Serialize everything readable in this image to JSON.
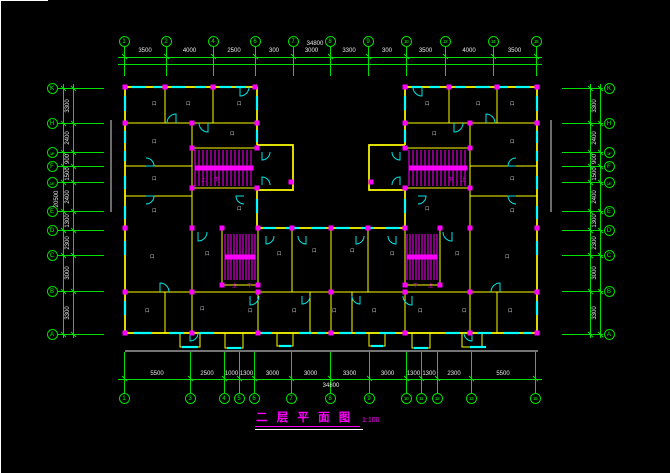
{
  "window": {
    "width": 670,
    "height": 473,
    "background": "#000000"
  },
  "colors": {
    "grid": "#00e000",
    "walls": "#ffff00",
    "windows": "#00ffff",
    "columns_stairs": "#ff00ff",
    "dim_text": "#e8e8e8",
    "section_line": "#a8a8a8"
  },
  "title_block": {
    "title": "二 层 平 面 图",
    "scale": "1:100"
  },
  "grid": {
    "top_axes": [
      {
        "label": "1",
        "x": 124
      },
      {
        "label": "2",
        "x": 166
      },
      {
        "label": "4",
        "x": 213
      },
      {
        "label": "6",
        "x": 255
      },
      {
        "label": "7",
        "x": 293
      },
      {
        "label": "8",
        "x": 330
      },
      {
        "label": "9",
        "x": 368
      },
      {
        "label": "10",
        "x": 406
      },
      {
        "label": "12",
        "x": 445
      },
      {
        "label": "14",
        "x": 493
      },
      {
        "label": "15",
        "x": 536
      }
    ],
    "top_dims": [
      "3500",
      "4000",
      "2500",
      "300",
      "3000",
      "3300",
      "300",
      "3500",
      "4000",
      "3500"
    ],
    "top_overall": "34800",
    "bottom_axes": [
      {
        "label": "1",
        "x": 124
      },
      {
        "label": "3",
        "x": 190
      },
      {
        "label": "4",
        "x": 224
      },
      {
        "label": "5",
        "x": 239
      },
      {
        "label": "6",
        "x": 254
      },
      {
        "label": "7",
        "x": 291
      },
      {
        "label": "8",
        "x": 330
      },
      {
        "label": "9",
        "x": 369
      },
      {
        "label": "10",
        "x": 406
      },
      {
        "label": "11",
        "x": 421
      },
      {
        "label": "12",
        "x": 437
      },
      {
        "label": "13",
        "x": 471
      },
      {
        "label": "15",
        "x": 535
      }
    ],
    "bottom_dims": [
      "5500",
      "2500",
      "1000",
      "1300",
      "3000",
      "3000",
      "3300",
      "3000",
      "1300",
      "1300",
      "2300",
      "5500"
    ],
    "bottom_overall": "34800",
    "side_axes": [
      {
        "label": "K",
        "y": 88
      },
      {
        "label": "H",
        "y": 123
      },
      {
        "label": "1/F",
        "y": 152
      },
      {
        "label": "F",
        "y": 166
      },
      {
        "label": "1/E",
        "y": 182
      },
      {
        "label": "E",
        "y": 211
      },
      {
        "label": "D",
        "y": 230
      },
      {
        "label": "C",
        "y": 255
      },
      {
        "label": "B",
        "y": 291
      },
      {
        "label": "A",
        "y": 334
      }
    ],
    "side_dims": [
      "3300",
      "2400",
      "900",
      "1500",
      "2400",
      "1300",
      "2300",
      "3000",
      "3300"
    ],
    "left_overall": "20500"
  },
  "drawing": {
    "columns": [
      [
        125,
        87
      ],
      [
        165,
        87
      ],
      [
        213,
        87
      ],
      [
        255,
        87
      ],
      [
        405,
        87
      ],
      [
        449,
        87
      ],
      [
        497,
        87
      ],
      [
        537,
        87
      ],
      [
        125,
        123
      ],
      [
        192,
        123
      ],
      [
        257,
        123
      ],
      [
        405,
        123
      ],
      [
        470,
        123
      ],
      [
        537,
        123
      ],
      [
        192,
        148
      ],
      [
        257,
        148
      ],
      [
        192,
        188
      ],
      [
        257,
        188
      ],
      [
        291,
        182
      ],
      [
        405,
        148
      ],
      [
        470,
        148
      ],
      [
        405,
        188
      ],
      [
        470,
        188
      ],
      [
        371,
        182
      ],
      [
        125,
        228
      ],
      [
        192,
        228
      ],
      [
        222,
        228
      ],
      [
        258,
        228
      ],
      [
        292,
        228
      ],
      [
        331,
        228
      ],
      [
        368,
        228
      ],
      [
        405,
        228
      ],
      [
        440,
        228
      ],
      [
        470,
        228
      ],
      [
        537,
        228
      ],
      [
        222,
        285
      ],
      [
        258,
        285
      ],
      [
        405,
        285
      ],
      [
        440,
        285
      ],
      [
        125,
        292
      ],
      [
        192,
        292
      ],
      [
        258,
        292
      ],
      [
        331,
        292
      ],
      [
        405,
        292
      ],
      [
        470,
        292
      ],
      [
        537,
        292
      ],
      [
        125,
        333
      ],
      [
        192,
        333
      ],
      [
        258,
        333
      ],
      [
        331,
        333
      ],
      [
        405,
        333
      ],
      [
        470,
        333
      ],
      [
        537,
        333
      ]
    ],
    "windows_h": [
      [
        131,
        87,
        15
      ],
      [
        153,
        87,
        9
      ],
      [
        171,
        87,
        14
      ],
      [
        195,
        87,
        11
      ],
      [
        220,
        87,
        11
      ],
      [
        236,
        87,
        10
      ],
      [
        411,
        87,
        10
      ],
      [
        430,
        87,
        10
      ],
      [
        455,
        87,
        11
      ],
      [
        476,
        87,
        14
      ],
      [
        500,
        87,
        8
      ],
      [
        516,
        87,
        14
      ],
      [
        263,
        228,
        13
      ],
      [
        286,
        228,
        13
      ],
      [
        311,
        228,
        14
      ],
      [
        336,
        228,
        14
      ],
      [
        361,
        228,
        13
      ],
      [
        386,
        228,
        13
      ],
      [
        134,
        333,
        18
      ],
      [
        169,
        333,
        15
      ],
      [
        199,
        333,
        15
      ],
      [
        261,
        333,
        11
      ],
      [
        299,
        333,
        13
      ],
      [
        317,
        333,
        9
      ],
      [
        339,
        333,
        12
      ],
      [
        355,
        333,
        11
      ],
      [
        380,
        333,
        15
      ],
      [
        445,
        333,
        15
      ],
      [
        477,
        333,
        14
      ],
      [
        504,
        333,
        15
      ],
      [
        523,
        333,
        9
      ],
      [
        182,
        347,
        16
      ],
      [
        227,
        348,
        14
      ],
      [
        279,
        346,
        12
      ],
      [
        371,
        346,
        12
      ],
      [
        414,
        348,
        14
      ],
      [
        470,
        347,
        16
      ]
    ],
    "windows_v": [
      [
        125,
        96,
        15
      ],
      [
        125,
        131,
        12
      ],
      [
        125,
        151,
        10
      ],
      [
        125,
        176,
        13
      ],
      [
        125,
        206,
        13
      ],
      [
        125,
        241,
        14
      ],
      [
        125,
        301,
        14
      ],
      [
        537,
        96,
        15
      ],
      [
        537,
        131,
        12
      ],
      [
        537,
        151,
        10
      ],
      [
        537,
        176,
        13
      ],
      [
        537,
        206,
        13
      ],
      [
        537,
        241,
        14
      ],
      [
        537,
        301,
        14
      ],
      [
        257,
        96,
        14
      ],
      [
        257,
        130,
        12
      ],
      [
        257,
        199,
        14
      ],
      [
        405,
        96,
        14
      ],
      [
        405,
        130,
        12
      ],
      [
        405,
        199,
        14
      ]
    ],
    "doors": [
      [
        176,
        123,
        9,
        270,
        180
      ],
      [
        240,
        87,
        9,
        90,
        0
      ],
      [
        146,
        166,
        8,
        0,
        270
      ],
      [
        208,
        123,
        9,
        90,
        180
      ],
      [
        146,
        196,
        8,
        0,
        90
      ],
      [
        244,
        196,
        8,
        180,
        90
      ],
      [
        262,
        152,
        8,
        90,
        0
      ],
      [
        262,
        185,
        8,
        270,
        0
      ],
      [
        486,
        123,
        9,
        270,
        0
      ],
      [
        422,
        87,
        9,
        90,
        180
      ],
      [
        516,
        166,
        8,
        180,
        270
      ],
      [
        454,
        123,
        9,
        90,
        0
      ],
      [
        516,
        196,
        8,
        180,
        90
      ],
      [
        418,
        196,
        8,
        0,
        90
      ],
      [
        400,
        152,
        8,
        90,
        180
      ],
      [
        400,
        185,
        8,
        270,
        180
      ],
      [
        198,
        232,
        9,
        90,
        0
      ],
      [
        266,
        236,
        8,
        90,
        0
      ],
      [
        306,
        236,
        8,
        90,
        180
      ],
      [
        356,
        236,
        8,
        90,
        0
      ],
      [
        396,
        236,
        8,
        90,
        180
      ],
      [
        452,
        232,
        9,
        90,
        180
      ],
      [
        160,
        292,
        9,
        270,
        0
      ],
      [
        250,
        296,
        9,
        90,
        0
      ],
      [
        302,
        296,
        8,
        90,
        0
      ],
      [
        360,
        296,
        8,
        90,
        180
      ],
      [
        412,
        296,
        9,
        90,
        180
      ],
      [
        500,
        292,
        9,
        270,
        180
      ],
      [
        190,
        333,
        8,
        90,
        0
      ],
      [
        472,
        333,
        8,
        90,
        180
      ]
    ],
    "stairs": [
      {
        "x": 195,
        "y": 150,
        "w": 58,
        "h": 36,
        "step": 4
      },
      {
        "x": 409,
        "y": 150,
        "w": 58,
        "h": 36,
        "step": 4
      },
      {
        "x": 225,
        "y": 234,
        "w": 30,
        "h": 46,
        "step": 3
      },
      {
        "x": 407,
        "y": 234,
        "w": 30,
        "h": 46,
        "step": 3
      }
    ],
    "stair_marks": [
      {
        "x": 201,
        "y": 181,
        "t": "上"
      },
      {
        "x": 214,
        "y": 181,
        "t": "下"
      },
      {
        "x": 448,
        "y": 181,
        "t": "下"
      },
      {
        "x": 461,
        "y": 181,
        "t": "上"
      },
      {
        "x": 232,
        "y": 287,
        "t": "上"
      },
      {
        "x": 247,
        "y": 287,
        "t": "下"
      },
      {
        "x": 413,
        "y": 287,
        "t": "下"
      },
      {
        "x": 428,
        "y": 287,
        "t": "上"
      }
    ],
    "room_marker_char": "口",
    "room_markers": [
      [
        152,
        105
      ],
      [
        186,
        105
      ],
      [
        237,
        105
      ],
      [
        152,
        143
      ],
      [
        230,
        135
      ],
      [
        152,
        180
      ],
      [
        152,
        212
      ],
      [
        237,
        210
      ],
      [
        510,
        105
      ],
      [
        476,
        105
      ],
      [
        425,
        105
      ],
      [
        510,
        143
      ],
      [
        432,
        135
      ],
      [
        510,
        180
      ],
      [
        510,
        212
      ],
      [
        425,
        210
      ],
      [
        150,
        258
      ],
      [
        205,
        255
      ],
      [
        277,
        255
      ],
      [
        312,
        252
      ],
      [
        350,
        252
      ],
      [
        390,
        255
      ],
      [
        455,
        255
      ],
      [
        505,
        258
      ],
      [
        145,
        312
      ],
      [
        200,
        310
      ],
      [
        248,
        312
      ],
      [
        292,
        312
      ],
      [
        332,
        312
      ],
      [
        372,
        312
      ],
      [
        418,
        312
      ],
      [
        462,
        312
      ],
      [
        508,
        312
      ]
    ]
  }
}
